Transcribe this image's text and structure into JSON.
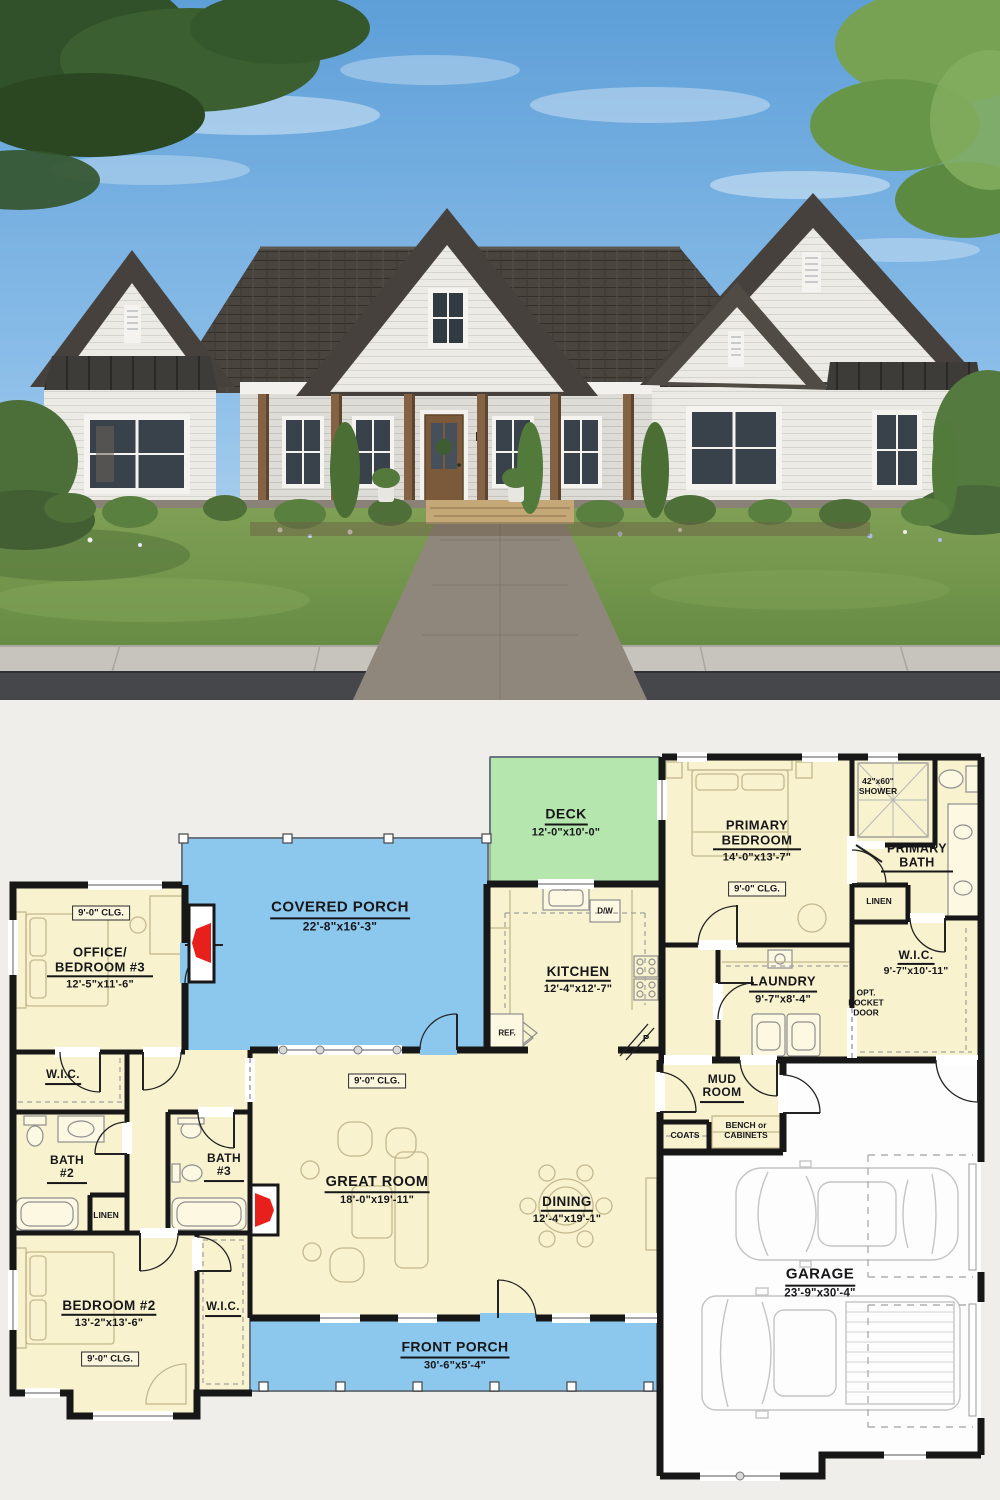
{
  "floor_plan": {
    "badge_clg": "9'-0\" CLG.",
    "rooms": {
      "deck": {
        "name": "DECK",
        "dims": "12'-0\"x10'-0\""
      },
      "covered_porch": {
        "name": "COVERED PORCH",
        "dims": "22'-8\"x16'-3\""
      },
      "office_bed3": {
        "name": "OFFICE/ BEDROOM #3",
        "dims": "12'-5\"x11'-6\""
      },
      "kitchen": {
        "name": "KITCHEN",
        "dims": "12'-4\"x12'-7\""
      },
      "primary_bedroom": {
        "name": "PRIMARY BEDROOM",
        "dims": "14'-0\"x13'-7\""
      },
      "primary_bath": {
        "name": "PRIMARY BATH"
      },
      "wic_primary": {
        "name": "W.I.C.",
        "dims": "9'-7\"x10'-11\""
      },
      "laundry": {
        "name": "LAUNDRY",
        "dims": "9'-7\"x8'-4\""
      },
      "mud_room": {
        "name": "MUD ROOM"
      },
      "great_room": {
        "name": "GREAT ROOM",
        "dims": "18'-0\"x19'-11\""
      },
      "dining": {
        "name": "DINING",
        "dims": "12'-4\"x19'-1\""
      },
      "bath2": {
        "name": "BATH #2"
      },
      "bath3": {
        "name": "BATH #3"
      },
      "bedroom2": {
        "name": "BEDROOM #2",
        "dims": "13'-2\"x13'-6\""
      },
      "wic_left": {
        "name": "W.I.C."
      },
      "wic_bedroom2": {
        "name": "W.I.C."
      },
      "front_porch": {
        "name": "FRONT PORCH",
        "dims": "30'-6\"x5'-4\""
      },
      "garage": {
        "name": "GARAGE",
        "dims": "23'-9\"x30'-4\""
      }
    },
    "small": {
      "shower": "42\"x60\" SHOWER",
      "linen": "LINEN",
      "opt_pocket_door": "OPT. POCKET DOOR",
      "coats": "COATS",
      "bench": "BENCH or CABINETS",
      "ref": "REF.",
      "dw": "D/W",
      "pantry": "P"
    },
    "colors": {
      "floor": "#f8f2cf",
      "porch": "#8cc7ee",
      "deck": "#b4e6ae",
      "walls": "#171717",
      "fireplace_red": "#e8201c",
      "garage_floor": "#fdfdfd",
      "background": "#f0eeea"
    }
  },
  "photo_colors": {
    "sky": "#6aa8de",
    "roof": "#433e39",
    "siding": "#eceae4",
    "lawn": "#73974e",
    "wood": "#846244",
    "road": "#45474a"
  }
}
